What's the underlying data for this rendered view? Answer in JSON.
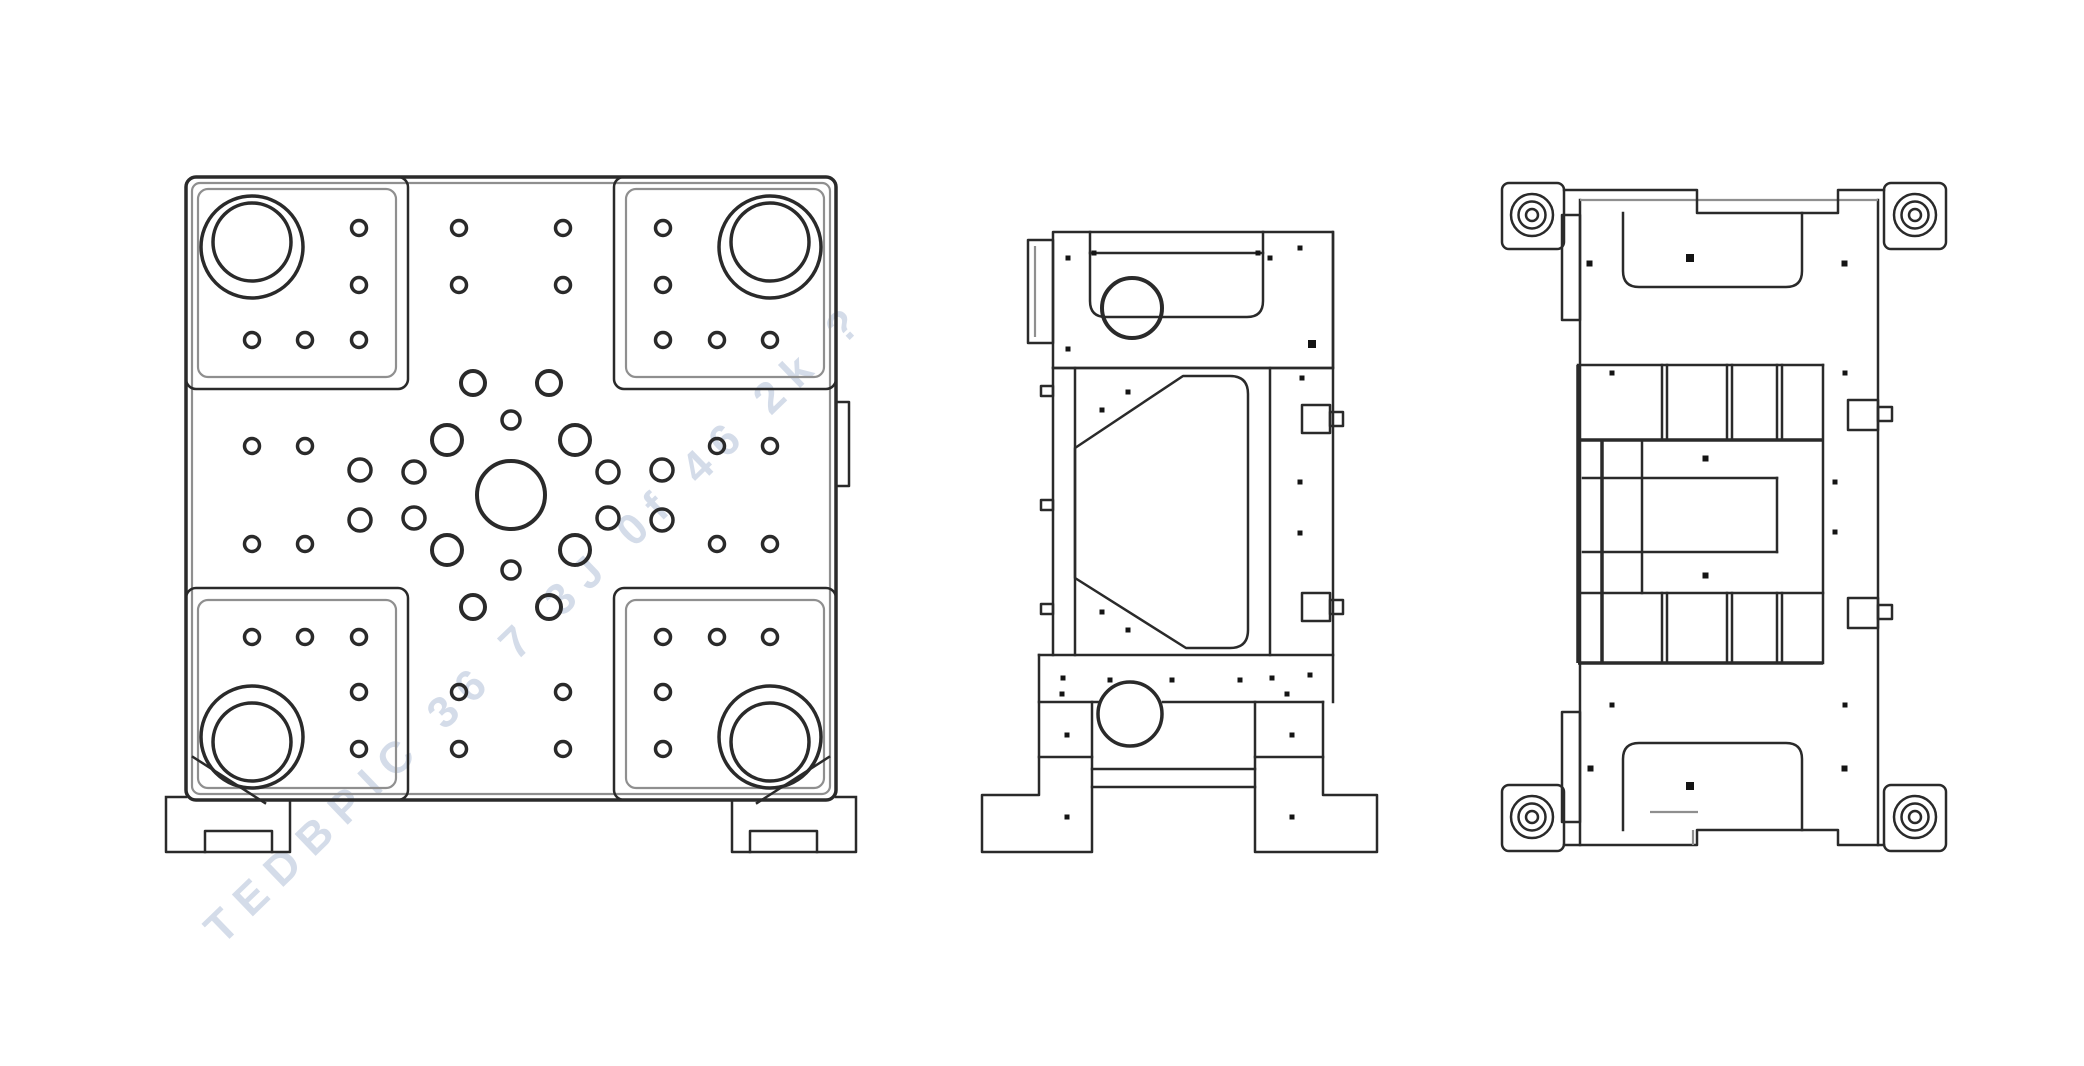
{
  "drawing": {
    "background_color": "#ffffff",
    "line_color": "#2a2a2a",
    "secondary_line_color": "#8f8f8f",
    "watermark": {
      "text": "TEDBPIC 36 7 3J 0f 46 2k ?",
      "color": "rgba(141,162,196,0.38)",
      "rotation_deg": -44
    }
  }
}
